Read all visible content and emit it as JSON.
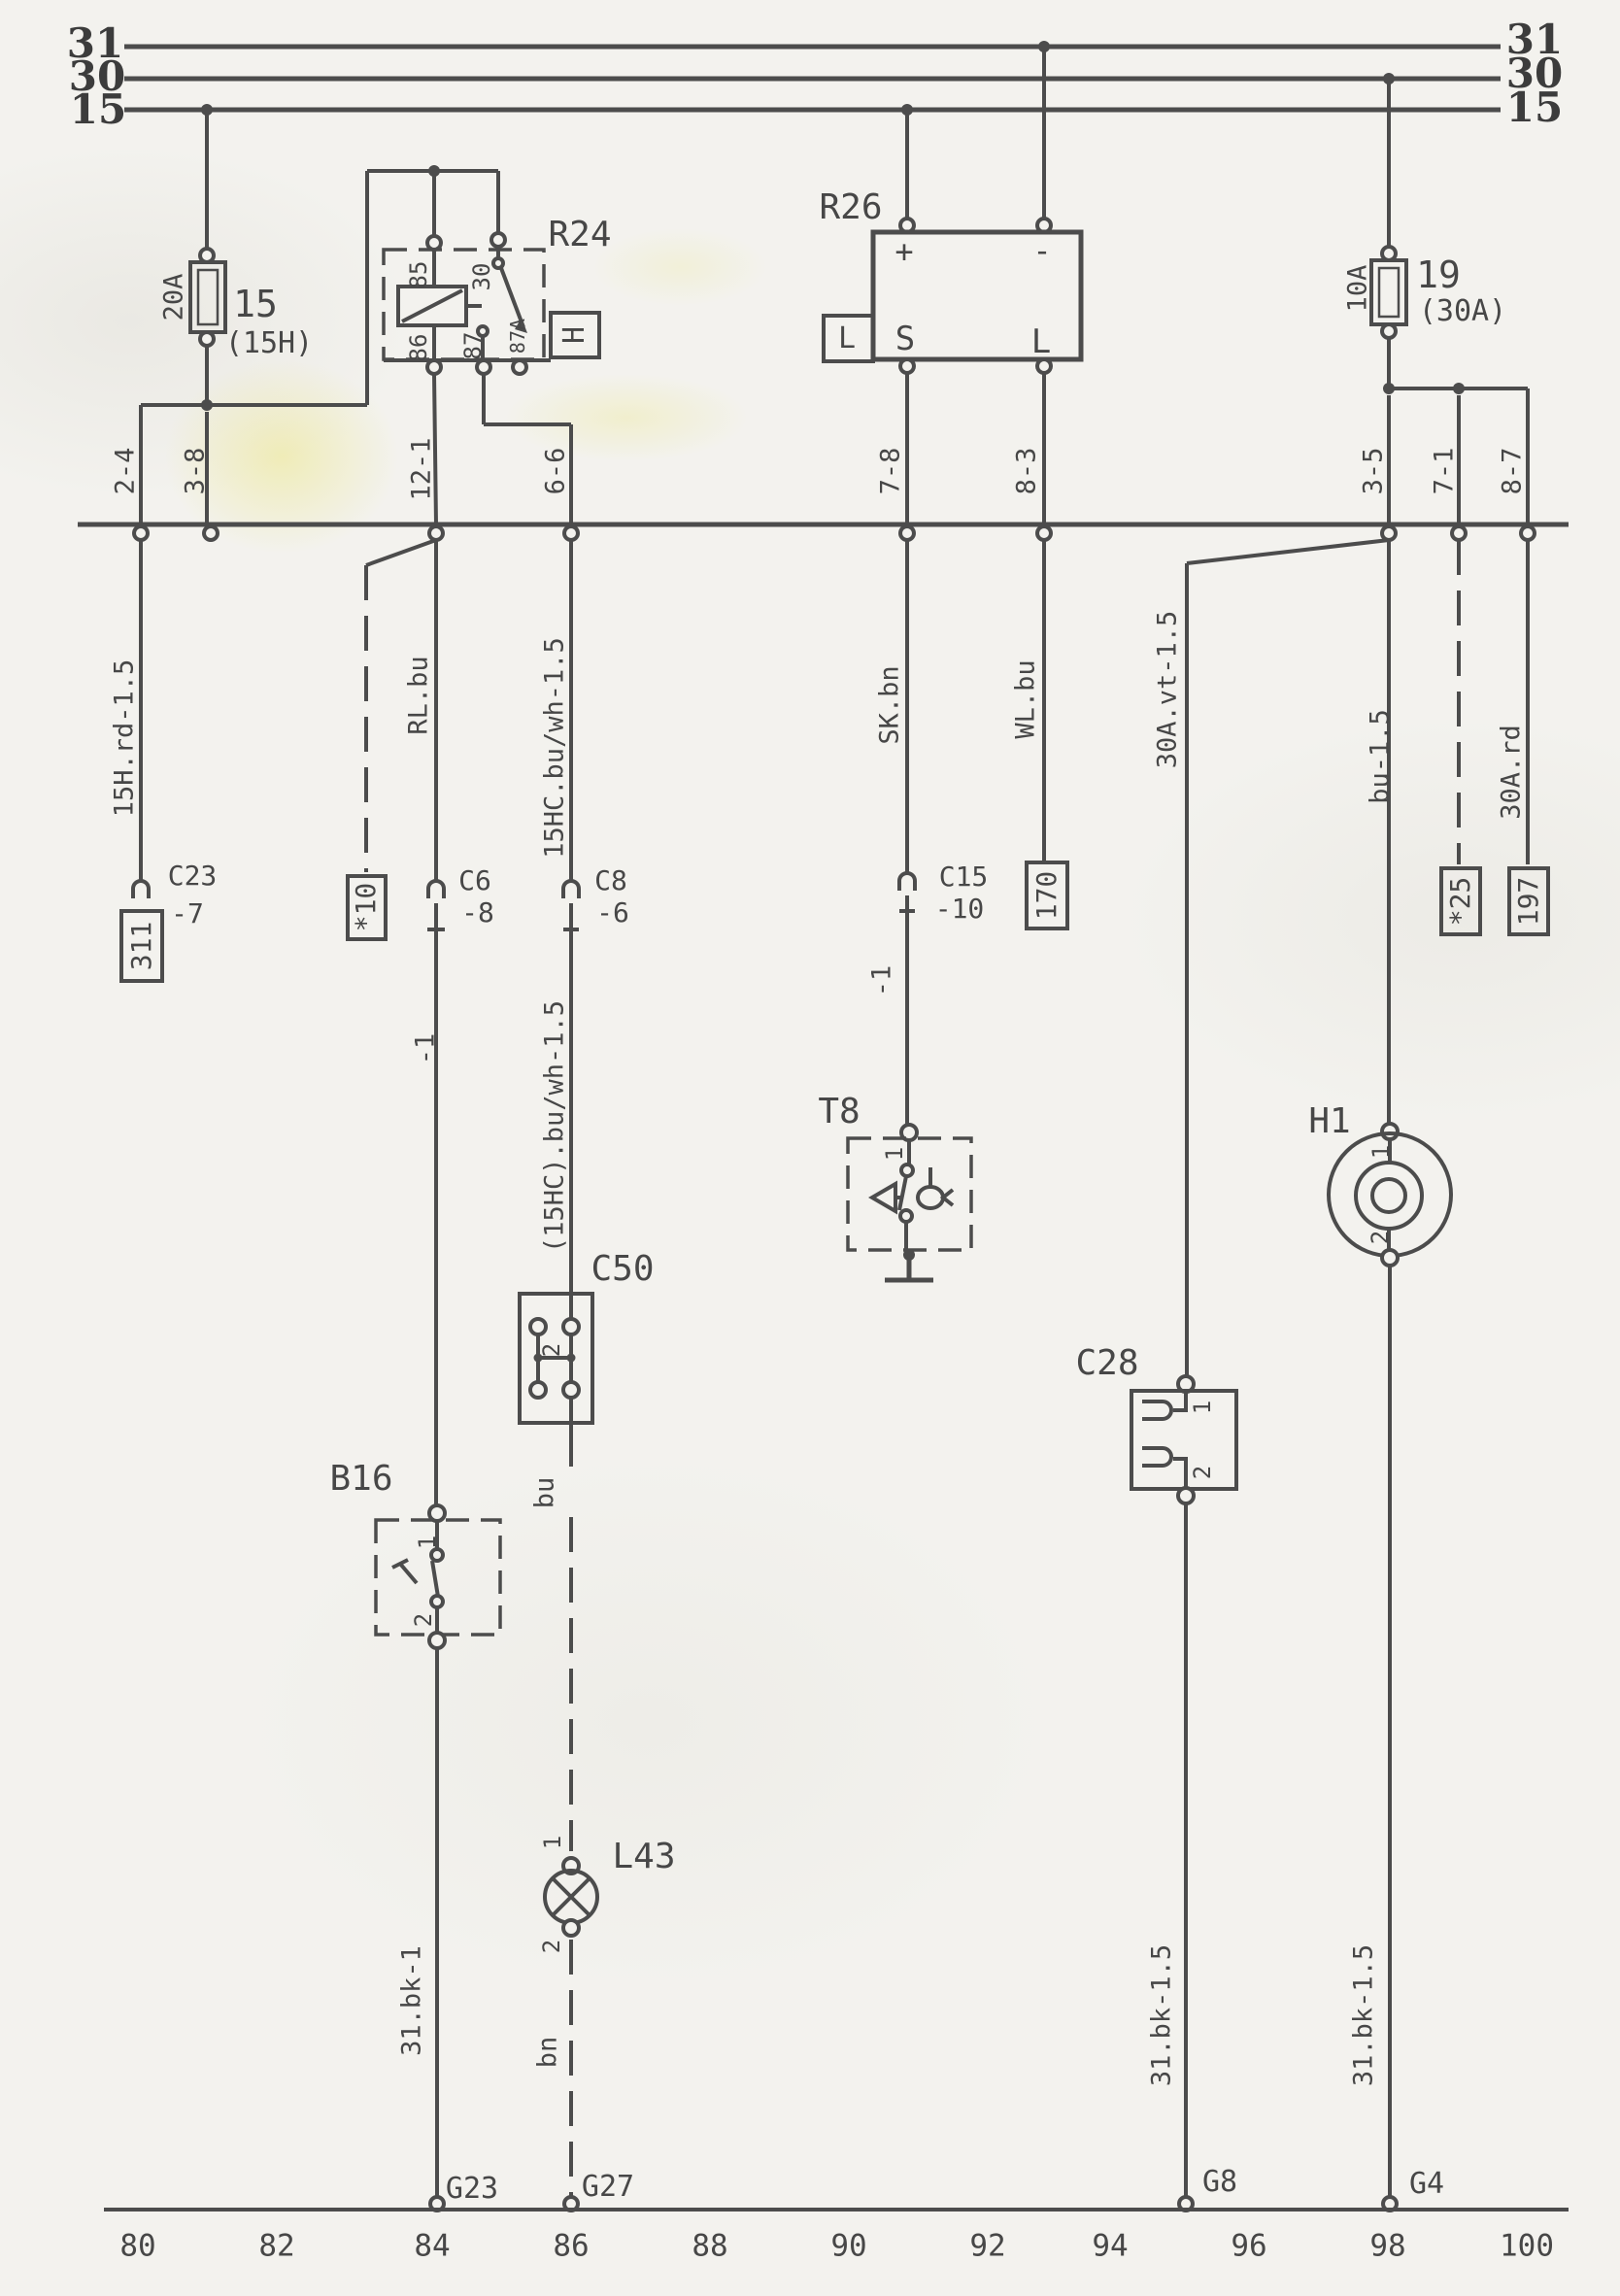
{
  "bus": {
    "n31": "31",
    "n30": "30",
    "n15": "15"
  },
  "fuses": {
    "f15": {
      "rating": "20A",
      "id": "15",
      "alt": "(15H)"
    },
    "f19": {
      "rating": "10A",
      "id": "19",
      "alt": "(30A)"
    }
  },
  "relay_r24": {
    "id": "R24",
    "pin85": "85",
    "pin30": "30",
    "pin86": "86",
    "pin87": "87",
    "pin87a": "87A",
    "dest": "H"
  },
  "unit_r26": {
    "id": "R26",
    "plus": "+",
    "minus": "-",
    "pin_s": "S",
    "pin_l": "L",
    "side": "L"
  },
  "row": {
    "p1": "2-4",
    "p2": "3-8",
    "p3": "12-1",
    "p4": "6-6",
    "p5": "7-8",
    "p6": "8-3",
    "p7": "3-5",
    "p8": "7-1",
    "p9": "8-7"
  },
  "wires": {
    "left": "15H.rd-1.5",
    "rl": "RL.bu",
    "hc": "15HC.bu/wh-1.5",
    "hc2": "(15HC).bu/wh-1.5",
    "sk": "SK.bn",
    "wl": "WL.bu",
    "vt": "30A.vt-1.5",
    "bu15": "bu-1.5",
    "rd": "30A.rd",
    "minus1_rl": "-1",
    "minus1_sk": "-1",
    "bu": "bu",
    "bn": "bn",
    "bk1": "31.bk-1",
    "bk15_l": "31.bk-1.5",
    "bk15_r": "31.bk-1.5"
  },
  "conns": {
    "c23": "C23",
    "c23_pin": "-7",
    "c6": "C6",
    "c6_pin": "-8",
    "c8": "C8",
    "c8_pin": "-6",
    "c15": "C15",
    "c15_pin": "-10"
  },
  "dests": {
    "d311": "311",
    "d10": "*10",
    "d170": "170",
    "d25": "*25",
    "d197": "197"
  },
  "units": {
    "t8": "T8",
    "t8_1": "1",
    "c50": "C50",
    "c50_2": "2",
    "b16": "B16",
    "b16_1": "1",
    "b16_2": "2",
    "l43": "L43",
    "l43_1": "1",
    "l43_2": "2",
    "c28": "C28",
    "c28_1": "1",
    "c28_2": "2",
    "h1": "H1",
    "h1_1": "1",
    "h1_2": "2"
  },
  "grounds": {
    "g23": "G23",
    "g27": "G27",
    "g8": "G8",
    "g4": "G4"
  },
  "axis": [
    "80",
    "82",
    "84",
    "86",
    "88",
    "90",
    "92",
    "94",
    "96",
    "98",
    "100"
  ]
}
